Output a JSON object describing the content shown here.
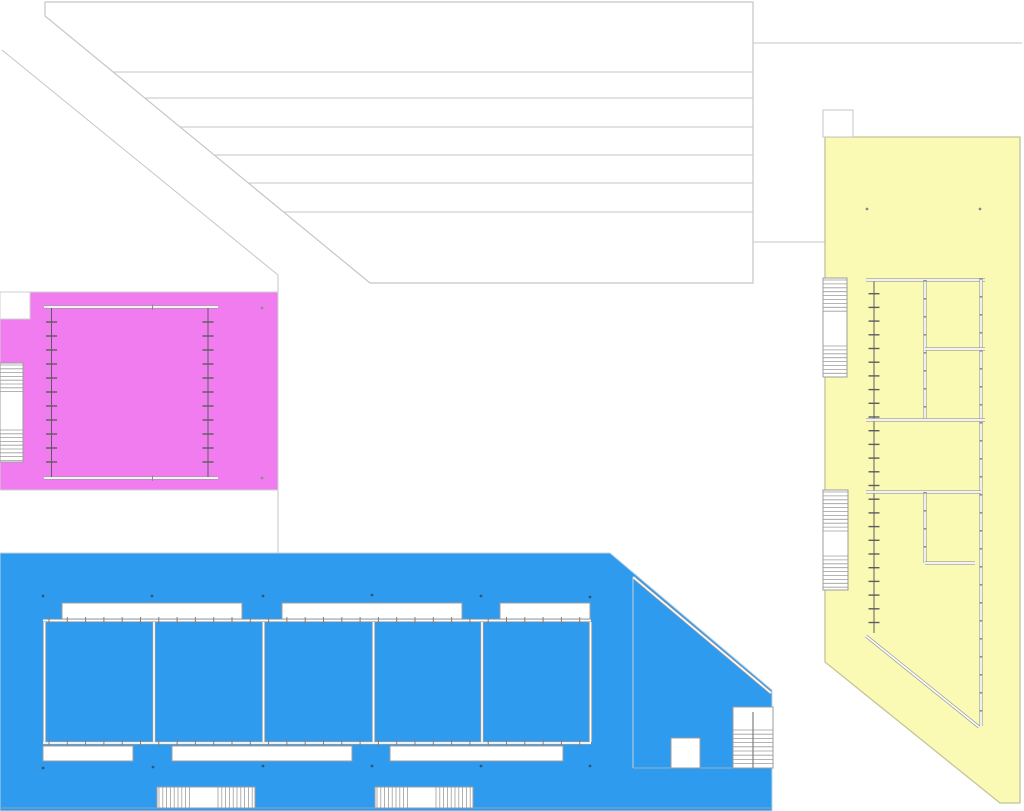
{
  "drawing": {
    "kind": "architectural-site-plan",
    "width": 1024,
    "height": 811,
    "background": "#ffffff",
    "palette": {
      "pink_wing": "#f17cef",
      "blue_wing": "#2f9bef",
      "yellow_wing": "#fafab5",
      "roof_line": "#c6c6c6",
      "wall_edge": "#9c9c9c",
      "wall_core": "#ffffff",
      "tick_dark": "#5d5d5d",
      "blue_dot": "#2f5876",
      "neutral_dot": "#8a8a8a"
    },
    "shapes": [
      {
        "name": "hall-roof-outline",
        "type": "polygon",
        "points": [
          [
            45,
            2
          ],
          [
            753,
            2
          ],
          [
            753,
            283
          ],
          [
            370,
            283
          ],
          [
            45,
            16
          ]
        ],
        "fill": "#ffffff",
        "stroke": "#c6c6c6",
        "sw": 1.2
      },
      {
        "name": "hall-roof-joint-1",
        "type": "line",
        "x1": 113,
        "y1": 72,
        "x2": 753,
        "y2": 72,
        "stroke": "#c6c6c6",
        "sw": 1
      },
      {
        "name": "hall-roof-joint-2",
        "type": "line",
        "x1": 145,
        "y1": 98,
        "x2": 753,
        "y2": 98,
        "stroke": "#c6c6c6",
        "sw": 1
      },
      {
        "name": "hall-roof-joint-3",
        "type": "line",
        "x1": 180,
        "y1": 127,
        "x2": 753,
        "y2": 127,
        "stroke": "#c6c6c6",
        "sw": 1
      },
      {
        "name": "hall-roof-joint-4",
        "type": "line",
        "x1": 214,
        "y1": 155,
        "x2": 753,
        "y2": 155,
        "stroke": "#c6c6c6",
        "sw": 1
      },
      {
        "name": "hall-roof-joint-5",
        "type": "line",
        "x1": 248,
        "y1": 183,
        "x2": 753,
        "y2": 183,
        "stroke": "#c6c6c6",
        "sw": 1
      },
      {
        "name": "hall-roof-joint-6",
        "type": "line",
        "x1": 284,
        "y1": 212,
        "x2": 753,
        "y2": 212,
        "stroke": "#c6c6c6",
        "sw": 1
      },
      {
        "name": "site-diagonal-path",
        "type": "line",
        "x1": 2,
        "y1": 50,
        "x2": 278,
        "y2": 275,
        "stroke": "#c6c6c6",
        "sw": 1
      },
      {
        "name": "site-diagonal-drop",
        "type": "line",
        "x1": 278,
        "y1": 275,
        "x2": 278,
        "y2": 292,
        "stroke": "#c6c6c6",
        "sw": 1
      },
      {
        "name": "site-divider-line",
        "type": "line",
        "x1": 278,
        "y1": 490,
        "x2": 278,
        "y2": 553,
        "stroke": "#c6c6c6",
        "sw": 1
      },
      {
        "name": "east-band-top-line",
        "type": "line",
        "x1": 753,
        "y1": 43,
        "x2": 1022,
        "y2": 43,
        "stroke": "#c6c6c6",
        "sw": 1
      },
      {
        "name": "east-band-bottom-line",
        "type": "line",
        "x1": 753,
        "y1": 242,
        "x2": 825,
        "y2": 242,
        "stroke": "#c6c6c6",
        "sw": 1
      },
      {
        "name": "yellow-wing-footprint",
        "type": "polygon",
        "points": [
          [
            825,
            137
          ],
          [
            1020,
            137
          ],
          [
            1020,
            803
          ],
          [
            1000,
            803
          ],
          [
            825,
            662
          ]
        ],
        "fill": "#fafab5",
        "stroke": "#c4c49a",
        "sw": 1.3
      },
      {
        "name": "yellow-roof-notch",
        "type": "rect",
        "x": 823,
        "y": 110,
        "w": 30,
        "h": 27,
        "fill": "#ffffff",
        "stroke": "#c6c6c6",
        "sw": 1
      },
      {
        "name": "yellow-stair-upper",
        "type": "stairs",
        "x": 823,
        "y": 278,
        "w": 24,
        "h": 99,
        "axis": "y",
        "sections": [
          [
            280,
            314
          ],
          [
            346,
            376
          ]
        ],
        "spacing": 3.9,
        "fill": "#ffffff",
        "stroke": "#9c9c9c"
      },
      {
        "name": "yellow-stair-lower",
        "type": "stairs",
        "x": 823,
        "y": 490,
        "w": 25,
        "h": 100,
        "axis": "y",
        "sections": [
          [
            492,
            532
          ],
          [
            556,
            589
          ]
        ],
        "spacing": 3.9,
        "fill": "#ffffff",
        "stroke": "#9c9c9c"
      },
      {
        "name": "yellow-curtain-wall-glazing",
        "type": "tickline",
        "x": 874,
        "y1": 280,
        "y2": 633,
        "spacing": 13.7,
        "tick": 11,
        "stroke": "#5d5d5d",
        "sw": 1
      },
      {
        "name": "yellow-wall-north",
        "type": "wall",
        "x1": 866,
        "y1": 280,
        "x2": 985,
        "y2": 280
      },
      {
        "name": "yellow-wall-mid-upper",
        "type": "wall",
        "x1": 925,
        "y1": 280,
        "x2": 925,
        "y2": 420,
        "nodes": 18
      },
      {
        "name": "yellow-wall-east",
        "type": "wall",
        "x1": 981,
        "y1": 278,
        "x2": 981,
        "y2": 726,
        "nodes": 18
      },
      {
        "name": "yellow-wall-room-split",
        "type": "wall",
        "x1": 925,
        "y1": 349,
        "x2": 985,
        "y2": 349
      },
      {
        "name": "yellow-wall-mid-horizontal",
        "type": "wall",
        "x1": 866,
        "y1": 420,
        "x2": 985,
        "y2": 420
      },
      {
        "name": "yellow-wall-lower-horizontal",
        "type": "wall",
        "x1": 866,
        "y1": 492,
        "x2": 981,
        "y2": 492
      },
      {
        "name": "yellow-wall-mid-lower",
        "type": "wall",
        "x1": 925,
        "y1": 492,
        "x2": 925,
        "y2": 563,
        "nodes": 18
      },
      {
        "name": "yellow-wall-room-split-lower",
        "type": "wall",
        "x1": 925,
        "y1": 563,
        "x2": 975,
        "y2": 563
      },
      {
        "name": "yellow-wall-diagonal",
        "type": "wall",
        "x1": 866,
        "y1": 636,
        "x2": 979,
        "y2": 727
      },
      {
        "name": "yellow-column-dots",
        "type": "dots",
        "r": 1.4,
        "fill": "#8a8a8a",
        "pts": [
          [
            867,
            209
          ],
          [
            980,
            209
          ]
        ]
      },
      {
        "name": "pink-wing-footprint",
        "type": "rect",
        "x": 0,
        "y": 292,
        "w": 278,
        "h": 198,
        "fill": "#f17cef",
        "stroke": "#cfcfcf",
        "sw": 1
      },
      {
        "name": "pink-corner-notch",
        "type": "rect",
        "x": 0,
        "y": 292,
        "w": 30,
        "h": 27,
        "fill": "#ffffff",
        "stroke": "#cfcfcf",
        "sw": 1
      },
      {
        "name": "pink-stair",
        "type": "stairs",
        "x": 0,
        "y": 363,
        "w": 23,
        "h": 99,
        "axis": "y",
        "sections": [
          [
            365,
            395
          ],
          [
            430,
            461
          ]
        ],
        "spacing": 3.8,
        "fill": "#ffffff",
        "stroke": "#9c9c9c"
      },
      {
        "name": "pink-hall-north-wall",
        "type": "wall",
        "x1": 44,
        "y1": 307,
        "x2": 218,
        "y2": 307
      },
      {
        "name": "pink-hall-south-wall",
        "type": "wall",
        "x1": 44,
        "y1": 478,
        "x2": 218,
        "y2": 478
      },
      {
        "name": "pink-hall-west-glazing",
        "type": "tickline",
        "x": 51.5,
        "y1": 308,
        "y2": 477,
        "spacing": 14,
        "tick": 11,
        "stroke": "#5d5d5d",
        "sw": 1
      },
      {
        "name": "pink-hall-east-glazing",
        "type": "tickline",
        "x": 208,
        "y1": 308,
        "y2": 477,
        "spacing": 14,
        "tick": 11,
        "stroke": "#5d5d5d",
        "sw": 1
      },
      {
        "name": "pink-north-wall-center-tick",
        "type": "line",
        "x1": 152.5,
        "y1": 304.5,
        "x2": 152.5,
        "y2": 310,
        "stroke": "#8a8a8a",
        "sw": 1
      },
      {
        "name": "pink-south-wall-center-tick",
        "type": "line",
        "x1": 152.5,
        "y1": 475.5,
        "x2": 152.5,
        "y2": 481,
        "stroke": "#8a8a8a",
        "sw": 1
      },
      {
        "name": "pink-column-dots",
        "type": "dots",
        "r": 1.4,
        "fill": "#8a8a8a",
        "pts": [
          [
            262,
            308
          ],
          [
            262,
            478
          ]
        ]
      },
      {
        "name": "blue-wing-footprint",
        "type": "polygon",
        "points": [
          [
            0,
            553
          ],
          [
            610,
            553
          ],
          [
            772,
            690
          ],
          [
            772,
            811
          ],
          [
            0,
            811
          ]
        ],
        "fill": "#2f9bef",
        "stroke": "#bcd3e6",
        "sw": 1
      },
      {
        "name": "blue-inner-eave-diagonal",
        "type": "wall",
        "x1": 633,
        "y1": 577,
        "x2": 771,
        "y2": 693
      },
      {
        "name": "blue-east-partition",
        "type": "line",
        "x1": 633,
        "y1": 577,
        "x2": 633,
        "y2": 768,
        "stroke": "#bcd3e6",
        "sw": 1
      },
      {
        "name": "blue-south-partition",
        "type": "line",
        "x1": 633,
        "y1": 768,
        "x2": 772,
        "y2": 768,
        "stroke": "#9ab0c0",
        "sw": 1
      },
      {
        "name": "blue-skylight-north-1",
        "type": "rect",
        "x": 62,
        "y": 603,
        "w": 180,
        "h": 16,
        "fill": "#ffffff",
        "stroke": "#9c9c9c",
        "sw": 1
      },
      {
        "name": "blue-skylight-north-2",
        "type": "rect",
        "x": 282,
        "y": 603,
        "w": 180,
        "h": 16,
        "fill": "#ffffff",
        "stroke": "#9c9c9c",
        "sw": 1
      },
      {
        "name": "blue-skylight-north-3",
        "type": "rect",
        "x": 500,
        "y": 603,
        "w": 90,
        "h": 16,
        "fill": "#ffffff",
        "stroke": "#9c9c9c",
        "sw": 1
      },
      {
        "name": "blue-hall-north-wall",
        "type": "tickwall",
        "x1": 43,
        "x2": 591,
        "y": 620.5,
        "spacing": 18.3,
        "tick": 7
      },
      {
        "name": "blue-hall-south-wall",
        "type": "tickwall",
        "x1": 43,
        "x2": 591,
        "y": 743,
        "spacing": 18.3,
        "tick": 7
      },
      {
        "name": "blue-room-wall-1",
        "type": "wall",
        "x1": 44.5,
        "y1": 622,
        "x2": 44.5,
        "y2": 742
      },
      {
        "name": "blue-room-wall-2",
        "type": "wall",
        "x1": 154,
        "y1": 622,
        "x2": 154,
        "y2": 742
      },
      {
        "name": "blue-room-wall-3",
        "type": "wall",
        "x1": 263.5,
        "y1": 622,
        "x2": 263.5,
        "y2": 742
      },
      {
        "name": "blue-room-wall-4",
        "type": "wall",
        "x1": 373.5,
        "y1": 622,
        "x2": 373.5,
        "y2": 742
      },
      {
        "name": "blue-room-wall-5",
        "type": "wall",
        "x1": 482,
        "y1": 622,
        "x2": 482,
        "y2": 742
      },
      {
        "name": "blue-room-wall-6",
        "type": "wall",
        "x1": 590.5,
        "y1": 622,
        "x2": 590.5,
        "y2": 742
      },
      {
        "name": "blue-skylight-south-1",
        "type": "rect",
        "x": 43,
        "y": 746,
        "w": 90,
        "h": 15,
        "fill": "#ffffff",
        "stroke": "#9c9c9c",
        "sw": 1
      },
      {
        "name": "blue-skylight-south-2",
        "type": "rect",
        "x": 172,
        "y": 746,
        "w": 180,
        "h": 15,
        "fill": "#ffffff",
        "stroke": "#9c9c9c",
        "sw": 1
      },
      {
        "name": "blue-skylight-south-3",
        "type": "rect",
        "x": 390,
        "y": 746,
        "w": 173,
        "h": 15,
        "fill": "#ffffff",
        "stroke": "#9c9c9c",
        "sw": 1
      },
      {
        "name": "blue-column-dots-north",
        "type": "dots",
        "r": 1.4,
        "fill": "#2f5876",
        "pts": [
          [
            43,
            596
          ],
          [
            152,
            596
          ],
          [
            263,
            596
          ],
          [
            372,
            595
          ],
          [
            481,
            596
          ],
          [
            590,
            597
          ]
        ]
      },
      {
        "name": "blue-column-dots-south",
        "type": "dots",
        "r": 1.4,
        "fill": "#2f5876",
        "pts": [
          [
            43,
            768
          ],
          [
            153,
            767
          ],
          [
            263,
            766
          ],
          [
            372,
            766
          ],
          [
            481,
            766
          ],
          [
            590,
            766
          ]
        ]
      },
      {
        "name": "blue-court-square",
        "type": "rect",
        "x": 671,
        "y": 738,
        "w": 29,
        "h": 30,
        "fill": "#ffffff",
        "stroke": "#9c9c9c",
        "sw": 1
      },
      {
        "name": "blue-stair-east",
        "type": "stairs",
        "x": 733,
        "y": 707,
        "w": 40,
        "h": 61,
        "axis": "y",
        "sections": [
          [
            730,
            767
          ]
        ],
        "spacing": 4.2,
        "fill": "#ffffff",
        "stroke": "#9c9c9c",
        "centerline": true
      },
      {
        "name": "blue-baseline",
        "type": "line",
        "x1": 0,
        "y1": 808,
        "x2": 772,
        "y2": 808,
        "stroke": "#8fa6b8",
        "sw": 1
      },
      {
        "name": "blue-stair-south-1",
        "type": "stairs",
        "x": 157,
        "y": 787,
        "w": 98,
        "h": 21,
        "axis": "x",
        "sections": [
          [
            159,
            190
          ],
          [
            218,
            253
          ]
        ],
        "spacing": 3.8,
        "fill": "#ffffff",
        "stroke": "#9c9c9c"
      },
      {
        "name": "blue-stair-south-2",
        "type": "stairs",
        "x": 375,
        "y": 787,
        "w": 98,
        "h": 21,
        "axis": "x",
        "sections": [
          [
            377,
            408
          ],
          [
            436,
            471
          ]
        ],
        "spacing": 3.8,
        "fill": "#ffffff",
        "stroke": "#9c9c9c"
      }
    ]
  }
}
